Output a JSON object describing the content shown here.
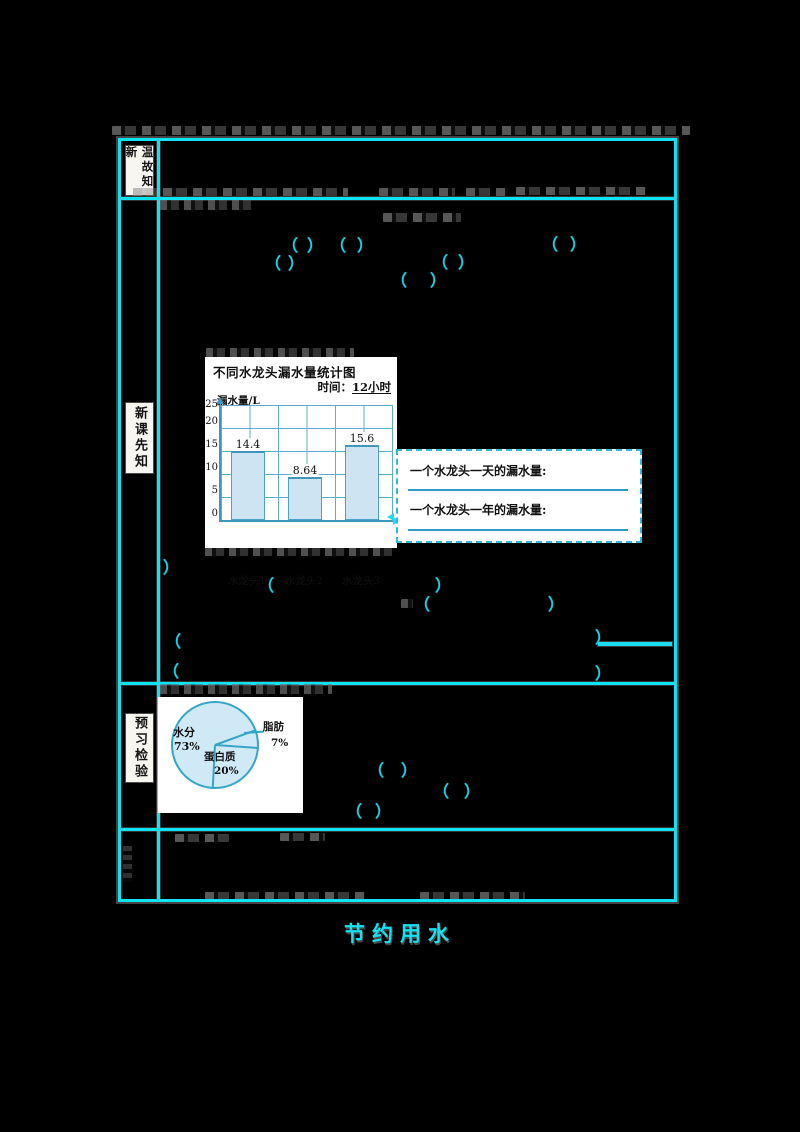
{
  "page": {
    "footer_text": "节约用水",
    "background": "#000000"
  },
  "colors": {
    "table_border": "#0be4f4",
    "bracket_cyan": "#10d4ea",
    "chart_axis": "#3f95ba",
    "chart_grid": "#5caecd",
    "bar_fill": "#cfe4f2",
    "pie_fill": "#cfe9f6",
    "pie_outline": "#35a5c8",
    "panel_bg": "#ffffff"
  },
  "glyphs": {
    "open": "（",
    "close": "）"
  },
  "sidebar": {
    "row1_label": "温故知新",
    "row2_label": "新课先知",
    "row3_label": "预习检验"
  },
  "note_box": {
    "line1": "一个水龙头一天的漏水量:",
    "line2": "一个水龙头一年的漏水量:"
  },
  "chart_data": [
    {
      "type": "bar",
      "title": "不同水龙头漏水量统计图",
      "time_label": "时间：",
      "time_value": "12小时",
      "ylabel": "漏水量/L",
      "yticks": [
        0,
        5,
        10,
        15,
        20,
        25
      ],
      "ylim": [
        0,
        25
      ],
      "grid": true,
      "categories": [
        "水龙头1",
        "水龙头2",
        "水龙头3"
      ],
      "values": [
        14.4,
        8.64,
        15.6
      ]
    },
    {
      "type": "pie",
      "labels": [
        "水分",
        "蛋白质",
        "脂肪"
      ],
      "values": [
        73,
        20,
        7
      ],
      "slices": [
        {
          "label": "水分",
          "pct_text": "73%"
        },
        {
          "label": "蛋白质",
          "pct_text": "20%"
        },
        {
          "label": "脂肪",
          "pct_text": "7%"
        }
      ]
    }
  ]
}
